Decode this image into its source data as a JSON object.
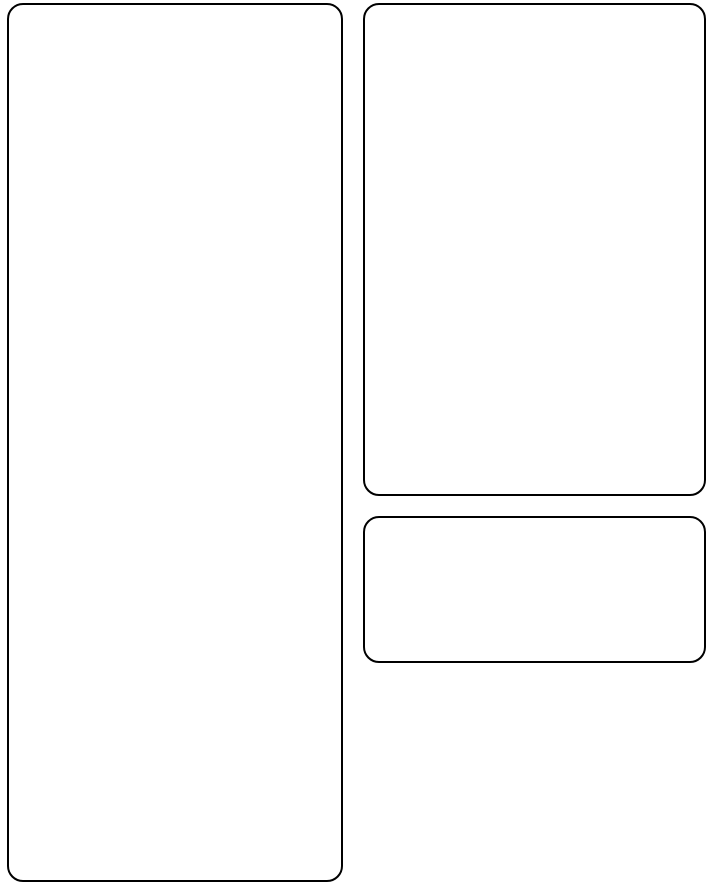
{
  "canvas": {
    "background": "#ffffff",
    "shape_stroke": "#000000"
  },
  "shapes": [
    {
      "name": "left-tall-rounded-rectangle",
      "label": ""
    },
    {
      "name": "top-right-rounded-rectangle",
      "label": ""
    },
    {
      "name": "bottom-right-small-rounded-rectangle",
      "label": ""
    }
  ]
}
